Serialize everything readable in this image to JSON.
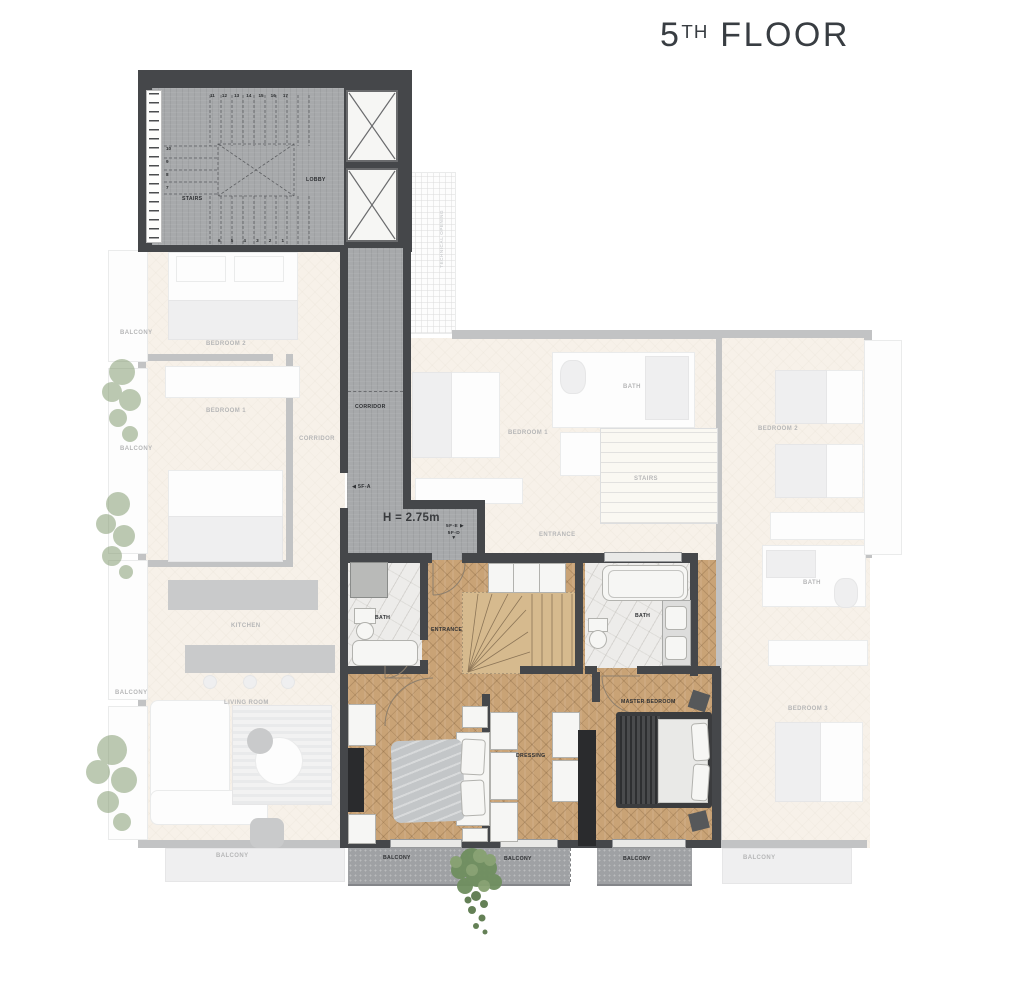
{
  "title": {
    "number": "5",
    "ordinal": "TH",
    "word": "FLOOR"
  },
  "plan": {
    "core": {
      "stairs": "STAIRS",
      "lobby": "LOBBY",
      "steps_top": [
        "11",
        "12",
        "13",
        "14",
        "15",
        "16",
        "17"
      ],
      "steps_left": [
        "10",
        "9",
        "8",
        "7"
      ],
      "steps_bottom": [
        "6",
        "5",
        "4",
        "3",
        "2",
        "1"
      ]
    },
    "corridor": {
      "label": "CORRIDOR",
      "height_note": "H = 2.75m"
    },
    "markers": {
      "a": {
        "arrow": "◀",
        "label": "5F-A"
      },
      "e": {
        "label": "5F-E",
        "arrow": "▶"
      },
      "d": {
        "label": "5F-D",
        "arrow": "▼"
      }
    },
    "unit": {
      "bath_left": "BATH",
      "entrance": "ENTRANCE",
      "bath_right": "BATH",
      "dressing": "DRESSING",
      "master_bedroom": "MASTER BEDROOM",
      "balcony_1": "BALCONY",
      "balcony_2": "BALCONY",
      "balcony_3": "BALCONY"
    },
    "left_unit": {
      "balcony_1": "BALCONY",
      "bedroom_2": "BEDROOM 2",
      "bedroom_1": "BEDROOM 1",
      "corridor": "CORRIDOR",
      "balcony_2": "BALCONY",
      "kitchen": "KITCHEN",
      "living_room": "LIVING ROOM",
      "balcony_3": "BALCONY",
      "balcony_4": "BALCONY"
    },
    "middle_unit": {
      "bedroom_1": "BEDROOM 1",
      "bath": "BATH",
      "stairs": "STAIRS",
      "entrance": "ENTRANCE"
    },
    "right_unit": {
      "bedroom_2": "BEDROOM 2",
      "bath": "BATH",
      "bedroom_3": "BEDROOM 3",
      "balcony": "BALCONY"
    },
    "technical": {
      "label": "TECHNICAL OPENING"
    }
  },
  "colors": {
    "wall": "#45474a",
    "concrete": "#a7a9ab",
    "wood": "#c9a376",
    "marble": "#edecea",
    "balcony_floor": "#9fa1a4",
    "faded_floor": "#e7d7bf",
    "plant_green": "#6f8f5f",
    "label_text": "#2e3033",
    "title_text": "#383d42"
  }
}
